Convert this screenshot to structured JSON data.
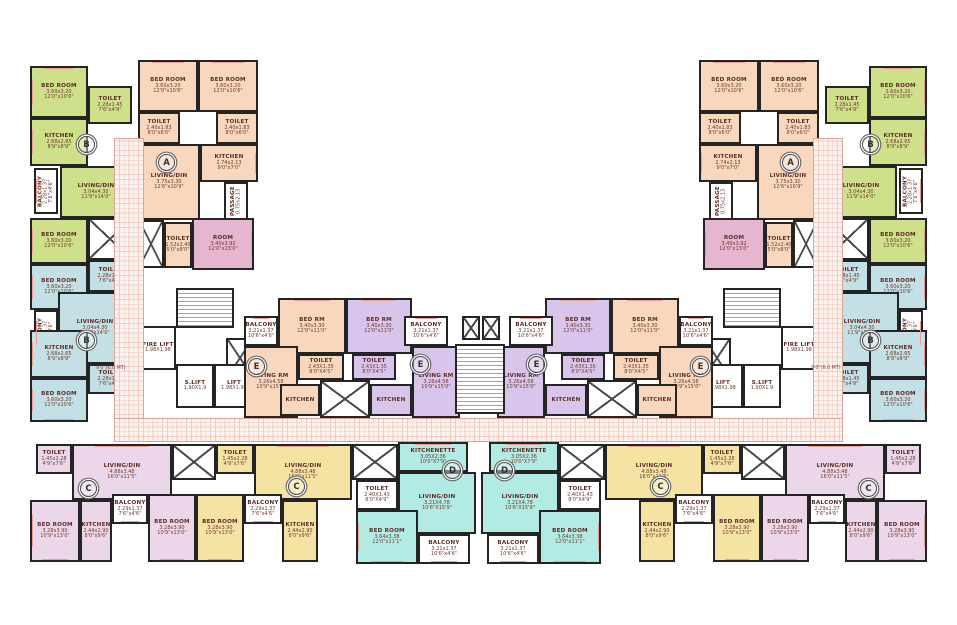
{
  "canvas": {
    "w": 957,
    "h": 625
  },
  "colors": {
    "green": "#cfe08b",
    "peach": "#f9d7bd",
    "pink": "#e6b5d0",
    "blue": "#c2e0e6",
    "purple": "#d9c5ec",
    "mauve": "#ecd7ea",
    "yellow": "#f5e3a4",
    "cyan": "#b2eae4",
    "white": "#ffffff"
  },
  "rooms": [
    {
      "id": "bedroom-green-top",
      "n": "BED ROOM",
      "d1": "3.60x3.20",
      "d2": "12'0\"x10'6\"",
      "x": 30,
      "y": 66,
      "w": 58,
      "h": 52,
      "f": "green",
      "win": [
        "left",
        "top"
      ]
    },
    {
      "id": "toilet-green-top",
      "n": "TOILET",
      "d1": "2.28x1.45",
      "d2": "7'6\"x4'9\"",
      "x": 88,
      "y": 86,
      "w": 44,
      "h": 38,
      "f": "green"
    },
    {
      "id": "kitchen-green",
      "n": "KITCHEN",
      "d1": "2.68x2.65",
      "d2": "8'9\"x8'9\"",
      "x": 30,
      "y": 118,
      "w": 58,
      "h": 48,
      "f": "green",
      "win": [
        "left"
      ]
    },
    {
      "id": "living-green",
      "n": "LIVING/DIN",
      "d1": "3.04x4.30",
      "d2": "11'9\"x14'0\"",
      "x": 60,
      "y": 166,
      "w": 72,
      "h": 52,
      "f": "green"
    },
    {
      "id": "balcony-green",
      "n": "BALCONY",
      "d1": "2.28x1.37",
      "d2": "7'6\"x4'6\"",
      "x": 34,
      "y": 168,
      "w": 24,
      "h": 46,
      "f": "white",
      "vert": true,
      "win": [
        "left"
      ]
    },
    {
      "id": "bedroom-green-2",
      "n": "BED ROOM",
      "d1": "3.60x3.20",
      "d2": "12'0\"x10'6\"",
      "x": 30,
      "y": 218,
      "w": 58,
      "h": 46,
      "f": "green",
      "win": [
        "left"
      ]
    },
    {
      "id": "duct-wing",
      "type": "duct",
      "x": 88,
      "y": 218,
      "w": 44,
      "h": 42,
      "f": "white"
    },
    {
      "id": "toilet-blue-1",
      "n": "TOILET",
      "d1": "2.28x1.45",
      "d2": "7'6\"x4'9\"",
      "x": 88,
      "y": 260,
      "w": 44,
      "h": 32,
      "f": "blue"
    },
    {
      "id": "bedroom-blue-1",
      "n": "BED ROOM",
      "d1": "3.60x3.20",
      "d2": "12'0\"x10'6\"",
      "x": 30,
      "y": 264,
      "w": 58,
      "h": 46,
      "f": "blue",
      "win": [
        "left"
      ]
    },
    {
      "id": "balcony-blue",
      "n": "BALCONY",
      "d1": "2.28x1.37",
      "d2": "7'6\"x4'6\"",
      "x": 34,
      "y": 310,
      "w": 24,
      "h": 46,
      "f": "white",
      "vert": true,
      "win": [
        "left"
      ]
    },
    {
      "id": "living-blue",
      "n": "LIVING/DIN",
      "d1": "3.04x4.30",
      "d2": "11'9\"x14'0\"",
      "x": 58,
      "y": 292,
      "w": 74,
      "h": 72,
      "f": "blue"
    },
    {
      "id": "kitchen-blue",
      "n": "KITCHEN",
      "d1": "2.68x2.65",
      "d2": "8'9\"x8'9\"",
      "x": 30,
      "y": 330,
      "w": 58,
      "h": 48,
      "f": "blue",
      "win": [
        "left"
      ]
    },
    {
      "id": "toilet-blue-2",
      "n": "TOILET",
      "d1": "2.28x1.45",
      "d2": "7'6\"x4'9\"",
      "x": 88,
      "y": 364,
      "w": 44,
      "h": 30,
      "f": "blue"
    },
    {
      "id": "bedroom-blue-2",
      "n": "BED ROOM",
      "d1": "3.60x3.20",
      "d2": "12'0\"x10'6\"",
      "x": 30,
      "y": 378,
      "w": 58,
      "h": 44,
      "f": "blue",
      "win": [
        "left",
        "bottom"
      ]
    },
    {
      "id": "bedroom-a-1",
      "n": "BED ROOM",
      "d1": "3.60x3.20",
      "d2": "12'0\"x10'6\"",
      "x": 138,
      "y": 60,
      "w": 60,
      "h": 52,
      "f": "peach",
      "win": [
        "top"
      ]
    },
    {
      "id": "bedroom-a-2",
      "n": "BED ROOM",
      "d1": "3.60x3.20",
      "d2": "12'0\"x10'6\"",
      "x": 198,
      "y": 60,
      "w": 60,
      "h": 52,
      "f": "peach",
      "win": [
        "top"
      ]
    },
    {
      "id": "toilet-a-1",
      "n": "TOILET",
      "d1": "2.40x1.83",
      "d2": "8'0\"x6'0\"",
      "x": 138,
      "y": 112,
      "w": 42,
      "h": 32,
      "f": "peach"
    },
    {
      "id": "toilet-a-2",
      "n": "TOILET",
      "d1": "2.40x1.83",
      "d2": "8'0\"x6'0\"",
      "x": 216,
      "y": 112,
      "w": 42,
      "h": 32,
      "f": "peach"
    },
    {
      "id": "kitchen-a",
      "n": "KITCHEN",
      "d1": "2.74x2.13",
      "d2": "9'0\"x7'0\"",
      "x": 200,
      "y": 144,
      "w": 58,
      "h": 38,
      "f": "peach",
      "win": [
        "right"
      ]
    },
    {
      "id": "living-a",
      "n": "LIVING/DIN",
      "d1": "3.75x3.30",
      "d2": "12'6\"x10'9\"",
      "x": 138,
      "y": 144,
      "w": 62,
      "h": 76,
      "f": "peach"
    },
    {
      "id": "passage-a",
      "n": "PASSAGE",
      "d1": "0.75x2.13",
      "d2": "",
      "x": 224,
      "y": 182,
      "w": 24,
      "h": 38,
      "f": "white",
      "vert": true
    },
    {
      "id": "stair-a",
      "type": "duct",
      "x": 138,
      "y": 220,
      "w": 26,
      "h": 48,
      "f": "white"
    },
    {
      "id": "toilet-a-3",
      "n": "TOILET",
      "d1": "1.52x2.40",
      "d2": "5'0\"x8'0\"",
      "x": 164,
      "y": 222,
      "w": 28,
      "h": 46,
      "f": "peach"
    },
    {
      "id": "room-pink",
      "n": "ROOM",
      "d1": "3.40x3.92",
      "d2": "12'0\"x13'0\"",
      "x": 192,
      "y": 218,
      "w": 62,
      "h": 52,
      "f": "pink",
      "win": [
        "right"
      ]
    },
    {
      "id": "stair-core",
      "type": "stair",
      "x": 176,
      "y": 288,
      "w": 58,
      "h": 40,
      "f": "white"
    },
    {
      "id": "fire-lift",
      "n": "FIRE LIFT",
      "d1": "1.98X1.98",
      "d2": "",
      "x": 140,
      "y": 326,
      "w": 36,
      "h": 44,
      "f": "white"
    },
    {
      "id": "duct-core",
      "type": "duct",
      "x": 226,
      "y": 338,
      "w": 28,
      "h": 40,
      "f": "white"
    },
    {
      "id": "s-lift",
      "n": "S.LIFT",
      "d1": "1.90X1.9",
      "d2": "",
      "x": 176,
      "y": 364,
      "w": 38,
      "h": 44,
      "f": "white"
    },
    {
      "id": "lift",
      "n": "LIFT",
      "d1": "1.98X1.98",
      "d2": "",
      "x": 214,
      "y": 364,
      "w": 40,
      "h": 44,
      "f": "white"
    },
    {
      "id": "balcony-e-outer",
      "n": "BALCONY",
      "d1": "3.21x1.37",
      "d2": "10'6\"x4'6\"",
      "x": 244,
      "y": 316,
      "w": 34,
      "h": 30,
      "f": "white",
      "win": [
        "top"
      ]
    },
    {
      "id": "bedrm-e-peach",
      "n": "BED RM",
      "d1": "3.40x3.30",
      "d2": "12'0\"x11'0\"",
      "x": 278,
      "y": 298,
      "w": 68,
      "h": 56,
      "f": "peach",
      "win": [
        "top"
      ]
    },
    {
      "id": "toilet-e-peach",
      "n": "TOILET",
      "d1": "2.43X1.35",
      "d2": "8'0\"X4'5\"",
      "x": 298,
      "y": 354,
      "w": 46,
      "h": 26,
      "f": "peach"
    },
    {
      "id": "living-e-peach",
      "n": "LIVING RM",
      "d1": "3.26x4.58",
      "d2": "10'9\"x15'0\"",
      "x": 244,
      "y": 346,
      "w": 54,
      "h": 72,
      "f": "peach"
    },
    {
      "id": "kitchen-e-peach",
      "n": "KITCHEN",
      "d1": "",
      "d2": "",
      "x": 280,
      "y": 384,
      "w": 40,
      "h": 32,
      "f": "peach"
    },
    {
      "id": "stair-e",
      "type": "duct",
      "x": 320,
      "y": 380,
      "w": 50,
      "h": 38,
      "f": "white"
    },
    {
      "id": "bedrm-e-purple",
      "n": "BED RM",
      "d1": "3.40x3.30",
      "d2": "12'0\"x11'0\"",
      "x": 346,
      "y": 298,
      "w": 66,
      "h": 56,
      "f": "purple",
      "win": [
        "top"
      ]
    },
    {
      "id": "toilet-e-purple",
      "n": "TOILET",
      "d1": "2.43X1.35",
      "d2": "8'0\"X4'5\"",
      "x": 352,
      "y": 354,
      "w": 44,
      "h": 26,
      "f": "purple"
    },
    {
      "id": "kitchen-e-purple",
      "n": "KITCHEN",
      "d1": "",
      "d2": "",
      "x": 370,
      "y": 384,
      "w": 42,
      "h": 32,
      "f": "purple"
    },
    {
      "id": "living-e-purple",
      "n": "LIVING RM",
      "d1": "3.26x4.58",
      "d2": "10'9\"x15'0\"",
      "x": 412,
      "y": 346,
      "w": 48,
      "h": 72,
      "f": "purple"
    },
    {
      "id": "balcony-e-inner",
      "n": "BALCONY",
      "d1": "3.21x1.37",
      "d2": "10'6\"x4'6\"",
      "x": 404,
      "y": 316,
      "w": 44,
      "h": 30,
      "f": "white",
      "win": [
        "top"
      ]
    },
    {
      "id": "duct-center-1",
      "type": "duct",
      "x": 462,
      "y": 316,
      "w": 18,
      "h": 24,
      "f": "white",
      "center": true
    },
    {
      "id": "duct-center-2",
      "type": "duct",
      "x": 482,
      "y": 316,
      "w": 18,
      "h": 24,
      "f": "white",
      "center": true
    },
    {
      "id": "stair-center",
      "type": "stair",
      "x": 455,
      "y": 344,
      "w": 50,
      "h": 70,
      "f": "white",
      "center": true
    },
    {
      "id": "toilet-c-mauve",
      "n": "TOILET",
      "d1": "1.45x2.28",
      "d2": "4'9\"x7'6\"",
      "x": 36,
      "y": 444,
      "w": 36,
      "h": 30,
      "f": "mauve"
    },
    {
      "id": "living-c-mauve",
      "n": "LIVING/DIN",
      "d1": "4.88x3.48",
      "d2": "16'0\"x11'5\"",
      "x": 72,
      "y": 444,
      "w": 100,
      "h": 56,
      "f": "mauve",
      "win": [
        "top"
      ]
    },
    {
      "id": "bedroom-c-mauve-1",
      "n": "BED ROOM",
      "d1": "3.28x3.90",
      "d2": "10'9\"x13'0\"",
      "x": 30,
      "y": 500,
      "w": 50,
      "h": 62,
      "f": "mauve",
      "win": [
        "left",
        "bottom"
      ]
    },
    {
      "id": "kitchen-c-mauve",
      "n": "KITCHEN",
      "d1": "2.44x2.90",
      "d2": "8'0\"x9'6\"",
      "x": 80,
      "y": 500,
      "w": 32,
      "h": 62,
      "f": "mauve"
    },
    {
      "id": "balcony-c-mauve",
      "n": "BALCONY",
      "d1": "2.29x1.37",
      "d2": "7'6\"x4'6\"",
      "x": 112,
      "y": 494,
      "w": 36,
      "h": 30,
      "f": "white",
      "win": [
        "bottom"
      ]
    },
    {
      "id": "bedroom-c-mauve-2",
      "n": "BED ROOM",
      "d1": "3.28x3.90",
      "d2": "10'9\"x13'0\"",
      "x": 148,
      "y": 494,
      "w": 48,
      "h": 68,
      "f": "mauve",
      "win": [
        "bottom"
      ]
    },
    {
      "id": "duct-c",
      "type": "duct",
      "x": 172,
      "y": 444,
      "w": 44,
      "h": 36,
      "f": "white"
    },
    {
      "id": "toilet-c-yellow",
      "n": "TOILET",
      "d1": "1.45x2.28",
      "d2": "4'9\"x7'6\"",
      "x": 216,
      "y": 444,
      "w": 38,
      "h": 30,
      "f": "yellow"
    },
    {
      "id": "living-c-yellow",
      "n": "LIVING/DIN",
      "d1": "4.88x3.48",
      "d2": "16'0\"x11'5\"",
      "x": 254,
      "y": 444,
      "w": 98,
      "h": 56,
      "f": "yellow",
      "win": [
        "top"
      ]
    },
    {
      "id": "bedroom-c-yellow",
      "n": "BED ROOM",
      "d1": "3.28x3.90",
      "d2": "10'9\"x13'0\"",
      "x": 196,
      "y": 494,
      "w": 48,
      "h": 68,
      "f": "yellow",
      "win": [
        "bottom"
      ]
    },
    {
      "id": "balcony-c-yellow",
      "n": "BALCONY",
      "d1": "2.29x1.37",
      "d2": "7'6\"x4'6\"",
      "x": 244,
      "y": 494,
      "w": 38,
      "h": 30,
      "f": "white",
      "win": [
        "bottom"
      ]
    },
    {
      "id": "kitchen-c-yellow",
      "n": "KITCHEN",
      "d1": "2.44x2.90",
      "d2": "8'0\"x9'6\"",
      "x": 282,
      "y": 500,
      "w": 36,
      "h": 62,
      "f": "yellow"
    },
    {
      "id": "duct-d",
      "type": "duct",
      "x": 352,
      "y": 444,
      "w": 46,
      "h": 36,
      "f": "white"
    },
    {
      "id": "kitchenette-d",
      "n": "KITCHENETTE",
      "d1": "3.05X2.36",
      "d2": "10'0\"X7'9\"",
      "x": 398,
      "y": 442,
      "w": 70,
      "h": 30,
      "f": "cyan",
      "win": [
        "top"
      ]
    },
    {
      "id": "toilet-d",
      "n": "TOILET",
      "d1": "2.40X1.43",
      "d2": "8'0\"X4'9\"",
      "x": 356,
      "y": 480,
      "w": 42,
      "h": 30,
      "f": "white"
    },
    {
      "id": "living-d",
      "n": "LIVING/DIN",
      "d1": "3.21X4.78",
      "d2": "10'6\"X15'9\"",
      "x": 398,
      "y": 472,
      "w": 78,
      "h": 62,
      "f": "cyan"
    },
    {
      "id": "bedroom-d",
      "n": "BED ROOM",
      "d1": "3.64x3.38",
      "d2": "12'0\"x11'1\"",
      "x": 356,
      "y": 510,
      "w": 62,
      "h": 54,
      "f": "cyan",
      "win": [
        "left",
        "bottom"
      ]
    },
    {
      "id": "balcony-d",
      "n": "BALCONY",
      "d1": "3.21x1.37",
      "d2": "10'6\"x4'6\"",
      "x": 418,
      "y": 534,
      "w": 52,
      "h": 30,
      "f": "white",
      "win": [
        "bottom"
      ]
    },
    {
      "id": "corridor-hatch-left",
      "type": "hatch",
      "x": 114,
      "y": 138,
      "w": 30,
      "h": 282
    },
    {
      "id": "corridor-hatch-main",
      "type": "hatch",
      "x": 114,
      "y": 418,
      "w": 729,
      "h": 24,
      "center": true
    }
  ],
  "unit_circles": [
    {
      "letter": "B",
      "x": 78,
      "y": 136
    },
    {
      "letter": "A",
      "x": 158,
      "y": 154
    },
    {
      "letter": "B",
      "x": 78,
      "y": 332
    },
    {
      "letter": "E",
      "x": 248,
      "y": 358
    },
    {
      "letter": "E",
      "x": 412,
      "y": 356
    },
    {
      "letter": "C",
      "x": 80,
      "y": 480
    },
    {
      "letter": "C",
      "x": 288,
      "y": 478
    },
    {
      "letter": "D",
      "x": 444,
      "y": 462
    }
  ],
  "annotations": [
    {
      "text": "9'0\"(6.0 MT)",
      "x": 96,
      "y": 366
    }
  ]
}
